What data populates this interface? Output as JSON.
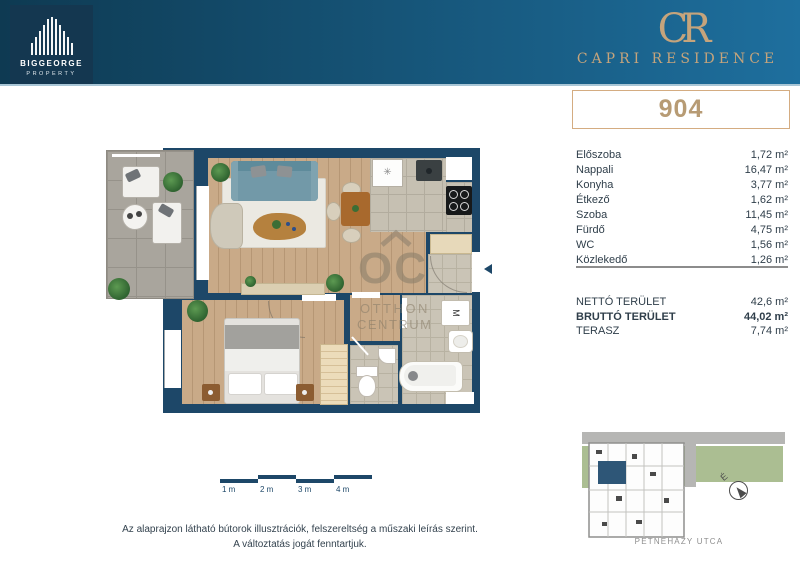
{
  "header": {
    "developer": {
      "name": "BIGGEORGE",
      "division": "PROPERTY"
    },
    "project": {
      "monogram": "CR",
      "name": "CAPRI RESIDENCE"
    }
  },
  "unit": {
    "number": "904"
  },
  "rooms": [
    {
      "label": "Előszoba",
      "area": "1,72 m²"
    },
    {
      "label": "Nappali",
      "area": "16,47 m²"
    },
    {
      "label": "Konyha",
      "area": "3,77 m²"
    },
    {
      "label": "Étkező",
      "area": "1,62 m²"
    },
    {
      "label": "Szoba",
      "area": "11,45 m²"
    },
    {
      "label": "Fürdő",
      "area": "4,75 m²"
    },
    {
      "label": "WC",
      "area": "1,56 m²"
    },
    {
      "label": "Közlekedő",
      "area": "1,26 m²"
    }
  ],
  "totals": [
    {
      "label": "NETTÓ TERÜLET",
      "value": "42,6 m²"
    },
    {
      "label": "BRUTTÓ TERÜLET",
      "value": "44,02 m²"
    },
    {
      "label": "TERASZ",
      "value": "7,74 m²"
    }
  ],
  "plan": {
    "watermark": {
      "monogram": "OC",
      "line1": "OTTHON",
      "line2": "CENTRUM"
    },
    "labels": {
      "washing_machine": "M",
      "freezer": "✳"
    }
  },
  "scale_bar": {
    "labels": [
      "1 m",
      "2 m",
      "3 m",
      "4 m"
    ]
  },
  "disclaimer": {
    "line1": "Az alaprajzon látható bútorok illusztrációk, felszereltség a műszaki leírás szerint.",
    "line2": "A változtatás jogát fenntartjuk."
  },
  "site_map": {
    "street": "PETNEHÁZY UTCA",
    "compass": "É"
  },
  "colors": {
    "header_gradient_start": "#0e3a52",
    "header_gradient_end": "#1e6f9e",
    "accent_gold": "#c5a47c",
    "wall_navy": "#1d4768",
    "unit_highlight": "#2e5677"
  }
}
